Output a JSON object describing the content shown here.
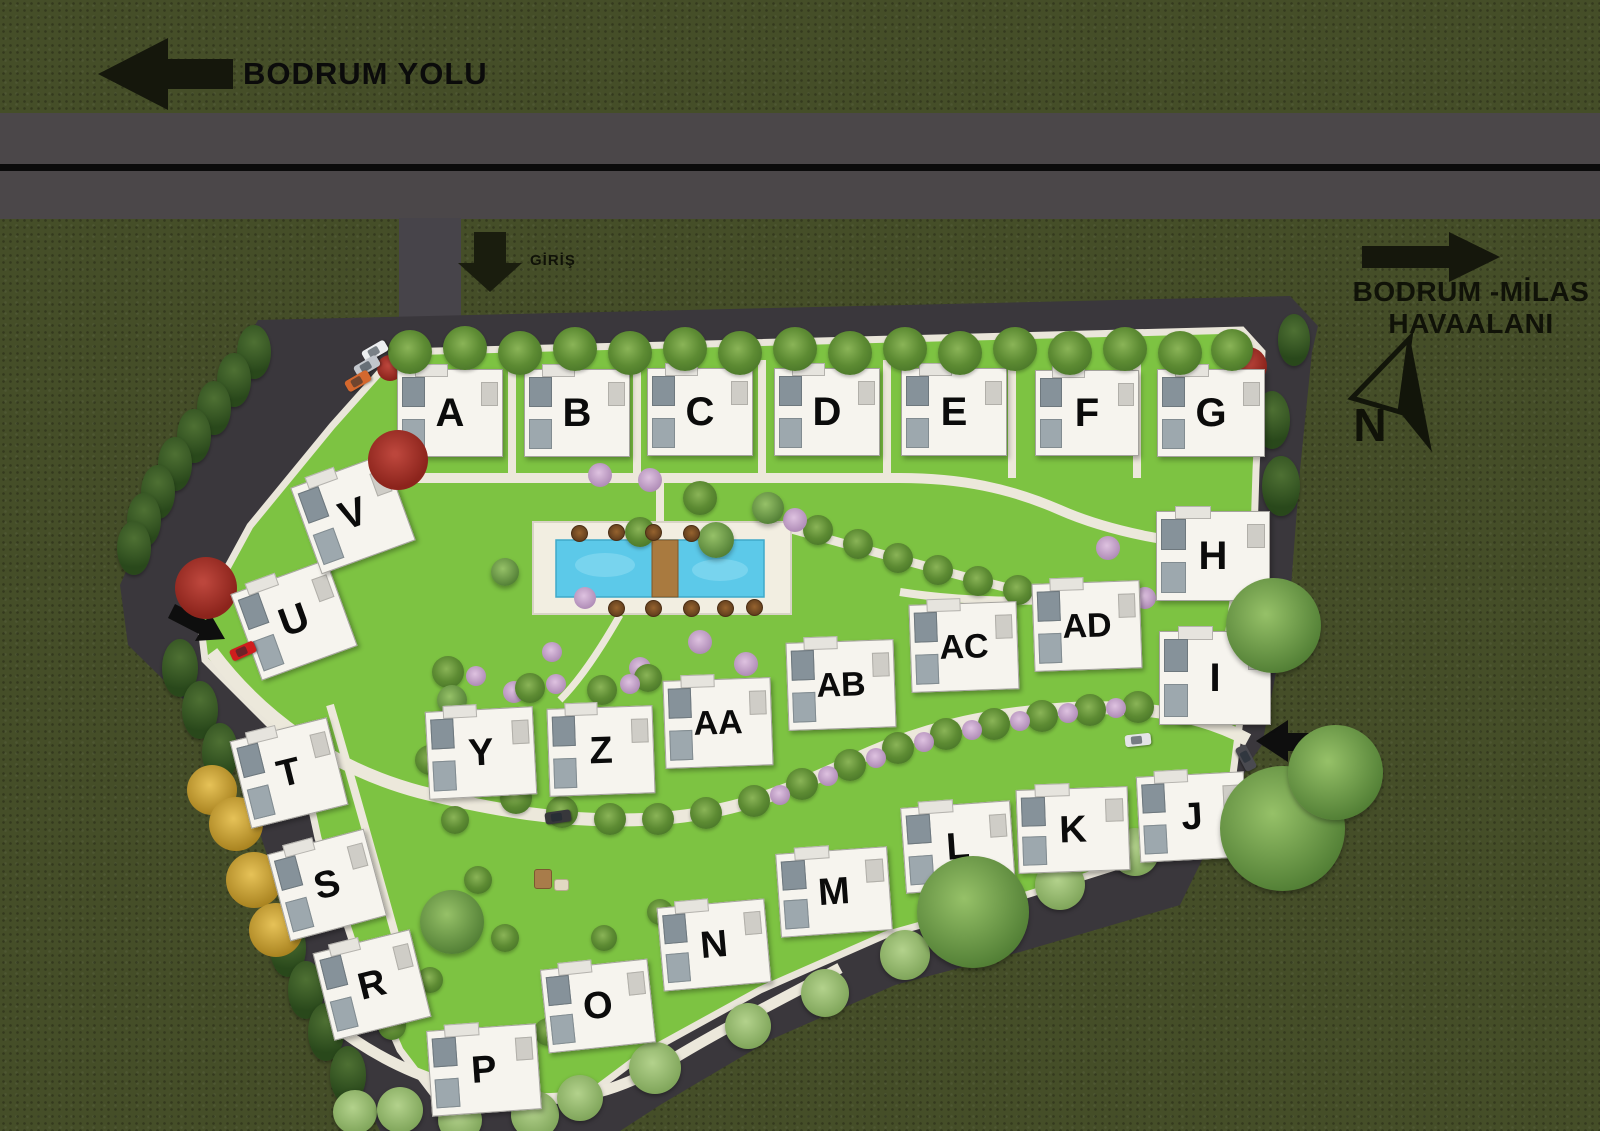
{
  "canvas": {
    "width": 1600,
    "height": 1131
  },
  "palette": {
    "outer_grass": "#454e28",
    "road": "#4b4749",
    "road_line": "#0b0b0b",
    "site_asphalt": "#3a373c",
    "lawn": "#7dc342",
    "path": "#ece8db",
    "pool_water": "#5cc9e9",
    "pool_deck": "#f2eee1",
    "building": "#f6f4ee",
    "sign_dark": "#15170c"
  },
  "signs": {
    "road_sign": {
      "label": "BODRUM YOLU",
      "direction": "left"
    },
    "entrance_sign": {
      "label": "GİRİŞ",
      "direction": "down"
    },
    "airport_sign": {
      "line1": "BODRUM -MİLAS",
      "line2": "HAVAALANI",
      "direction": "right"
    },
    "compass": {
      "label": "N"
    }
  },
  "buildings": [
    {
      "id": "A",
      "x": 449,
      "y": 412,
      "w": 104,
      "h": 86,
      "rot": 0,
      "fs": 40
    },
    {
      "id": "B",
      "x": 576,
      "y": 412,
      "w": 104,
      "h": 86,
      "rot": 0,
      "fs": 40
    },
    {
      "id": "C",
      "x": 699,
      "y": 411,
      "w": 104,
      "h": 86,
      "rot": 0,
      "fs": 40
    },
    {
      "id": "D",
      "x": 826,
      "y": 411,
      "w": 104,
      "h": 86,
      "rot": 0,
      "fs": 40
    },
    {
      "id": "E",
      "x": 953,
      "y": 411,
      "w": 104,
      "h": 86,
      "rot": 0,
      "fs": 40
    },
    {
      "id": "F",
      "x": 1086,
      "y": 412,
      "w": 102,
      "h": 84,
      "rot": 0,
      "fs": 40
    },
    {
      "id": "G",
      "x": 1210,
      "y": 412,
      "w": 106,
      "h": 86,
      "rot": 0,
      "fs": 40
    },
    {
      "id": "H",
      "x": 1212,
      "y": 555,
      "w": 112,
      "h": 88,
      "rot": 0,
      "fs": 40
    },
    {
      "id": "I",
      "x": 1214,
      "y": 677,
      "w": 110,
      "h": 92,
      "rot": 0,
      "fs": 40
    },
    {
      "id": "J",
      "x": 1191,
      "y": 816,
      "w": 106,
      "h": 84,
      "rot": -3,
      "fs": 38
    },
    {
      "id": "K",
      "x": 1072,
      "y": 829,
      "w": 110,
      "h": 82,
      "rot": -2,
      "fs": 38
    },
    {
      "id": "L",
      "x": 957,
      "y": 846,
      "w": 108,
      "h": 84,
      "rot": -4,
      "fs": 38
    },
    {
      "id": "M",
      "x": 833,
      "y": 891,
      "w": 110,
      "h": 82,
      "rot": -4,
      "fs": 38
    },
    {
      "id": "N",
      "x": 713,
      "y": 944,
      "w": 106,
      "h": 82,
      "rot": -5,
      "fs": 38
    },
    {
      "id": "O",
      "x": 597,
      "y": 1005,
      "w": 106,
      "h": 82,
      "rot": -6,
      "fs": 38
    },
    {
      "id": "P",
      "x": 483,
      "y": 1069,
      "w": 108,
      "h": 84,
      "rot": -4,
      "fs": 38
    },
    {
      "id": "R",
      "x": 371,
      "y": 984,
      "w": 98,
      "h": 88,
      "rot": -14,
      "fs": 38
    },
    {
      "id": "S",
      "x": 326,
      "y": 884,
      "w": 98,
      "h": 88,
      "rot": -15,
      "fs": 38
    },
    {
      "id": "T",
      "x": 288,
      "y": 772,
      "w": 98,
      "h": 88,
      "rot": -14,
      "fs": 38
    },
    {
      "id": "U",
      "x": 293,
      "y": 619,
      "w": 100,
      "h": 90,
      "rot": -20,
      "fs": 40
    },
    {
      "id": "V",
      "x": 352,
      "y": 513,
      "w": 98,
      "h": 90,
      "rot": -20,
      "fs": 40
    },
    {
      "id": "Y",
      "x": 480,
      "y": 752,
      "w": 106,
      "h": 86,
      "rot": -3,
      "fs": 38
    },
    {
      "id": "Z",
      "x": 600,
      "y": 750,
      "w": 104,
      "h": 86,
      "rot": -2,
      "fs": 38
    },
    {
      "id": "AA",
      "x": 717,
      "y": 722,
      "w": 106,
      "h": 86,
      "rot": -2,
      "fs": 34
    },
    {
      "id": "AB",
      "x": 840,
      "y": 684,
      "w": 106,
      "h": 86,
      "rot": -2,
      "fs": 34
    },
    {
      "id": "AC",
      "x": 963,
      "y": 646,
      "w": 106,
      "h": 86,
      "rot": -2,
      "fs": 34
    },
    {
      "id": "AD",
      "x": 1086,
      "y": 625,
      "w": 106,
      "h": 86,
      "rot": -2,
      "fs": 34
    }
  ],
  "pool": {
    "deck": {
      "x": 533,
      "y": 522,
      "w": 258,
      "h": 92
    },
    "water": {
      "x": 556,
      "y": 540,
      "w": 208,
      "h": 57
    },
    "bridge": {
      "x": 652,
      "y": 540,
      "w": 26,
      "h": 57
    }
  },
  "cars": [
    {
      "x": 375,
      "y": 351,
      "rot": -30,
      "color": "#eceef0"
    },
    {
      "x": 367,
      "y": 366,
      "rot": -30,
      "color": "#c2c6cc"
    },
    {
      "x": 358,
      "y": 381,
      "rot": -30,
      "color": "#d4682e"
    },
    {
      "x": 243,
      "y": 651,
      "rot": -24,
      "color": "#cf1d1d"
    },
    {
      "x": 558,
      "y": 817,
      "rot": -8,
      "color": "#37373b"
    },
    {
      "x": 1138,
      "y": 740,
      "rot": -6,
      "color": "#e4e4e6"
    },
    {
      "x": 1246,
      "y": 758,
      "rot": 62,
      "color": "#4a4a50"
    }
  ],
  "trees": [
    {
      "t": "palm",
      "x": 410,
      "y": 352,
      "s": 44,
      "top": true
    },
    {
      "t": "palm",
      "x": 465,
      "y": 348,
      "s": 44,
      "top": true
    },
    {
      "t": "palm",
      "x": 520,
      "y": 353,
      "s": 44,
      "top": true
    },
    {
      "t": "palm",
      "x": 575,
      "y": 349,
      "s": 44,
      "top": true
    },
    {
      "t": "palm",
      "x": 630,
      "y": 353,
      "s": 44,
      "top": true
    },
    {
      "t": "palm",
      "x": 685,
      "y": 349,
      "s": 44,
      "top": true
    },
    {
      "t": "palm",
      "x": 740,
      "y": 353,
      "s": 44,
      "top": true
    },
    {
      "t": "palm",
      "x": 795,
      "y": 349,
      "s": 44,
      "top": true
    },
    {
      "t": "palm",
      "x": 850,
      "y": 353,
      "s": 44,
      "top": true
    },
    {
      "t": "palm",
      "x": 905,
      "y": 349,
      "s": 44,
      "top": true
    },
    {
      "t": "palm",
      "x": 960,
      "y": 353,
      "s": 44,
      "top": true
    },
    {
      "t": "palm",
      "x": 1015,
      "y": 349,
      "s": 44,
      "top": true
    },
    {
      "t": "palm",
      "x": 1070,
      "y": 353,
      "s": 44,
      "top": true
    },
    {
      "t": "palm",
      "x": 1125,
      "y": 349,
      "s": 44,
      "top": true
    },
    {
      "t": "palm",
      "x": 1180,
      "y": 353,
      "s": 44,
      "top": true
    },
    {
      "t": "palm",
      "x": 1232,
      "y": 350,
      "s": 42,
      "top": true
    },
    {
      "t": "conifer",
      "x": 254,
      "y": 352,
      "s": 34
    },
    {
      "t": "conifer",
      "x": 234,
      "y": 380,
      "s": 34
    },
    {
      "t": "conifer",
      "x": 214,
      "y": 408,
      "s": 34
    },
    {
      "t": "conifer",
      "x": 194,
      "y": 436,
      "s": 34
    },
    {
      "t": "conifer",
      "x": 175,
      "y": 464,
      "s": 34
    },
    {
      "t": "conifer",
      "x": 158,
      "y": 492,
      "s": 34
    },
    {
      "t": "conifer",
      "x": 144,
      "y": 520,
      "s": 34
    },
    {
      "t": "conifer",
      "x": 134,
      "y": 548,
      "s": 34
    },
    {
      "t": "conifer",
      "x": 180,
      "y": 668,
      "s": 36
    },
    {
      "t": "conifer",
      "x": 200,
      "y": 710,
      "s": 36
    },
    {
      "t": "conifer",
      "x": 220,
      "y": 752,
      "s": 36
    },
    {
      "t": "conifer",
      "x": 288,
      "y": 948,
      "s": 36
    },
    {
      "t": "conifer",
      "x": 306,
      "y": 990,
      "s": 36
    },
    {
      "t": "conifer",
      "x": 326,
      "y": 1032,
      "s": 36
    },
    {
      "t": "conifer",
      "x": 348,
      "y": 1075,
      "s": 36
    },
    {
      "t": "yellow",
      "x": 212,
      "y": 790,
      "s": 50
    },
    {
      "t": "yellow",
      "x": 236,
      "y": 824,
      "s": 54
    },
    {
      "t": "yellow",
      "x": 254,
      "y": 880,
      "s": 56
    },
    {
      "t": "yellow",
      "x": 276,
      "y": 930,
      "s": 54
    },
    {
      "t": "red",
      "x": 398,
      "y": 460,
      "s": 60,
      "top": true
    },
    {
      "t": "red",
      "x": 206,
      "y": 588,
      "s": 62
    },
    {
      "t": "red",
      "x": 1248,
      "y": 366,
      "s": 38
    },
    {
      "t": "red",
      "x": 390,
      "y": 368,
      "s": 26
    },
    {
      "t": "palm",
      "x": 516,
      "y": 798,
      "s": 32
    },
    {
      "t": "palm",
      "x": 562,
      "y": 812,
      "s": 32
    },
    {
      "t": "palm",
      "x": 610,
      "y": 819,
      "s": 32
    },
    {
      "t": "palm",
      "x": 658,
      "y": 819,
      "s": 32
    },
    {
      "t": "palm",
      "x": 706,
      "y": 813,
      "s": 32
    },
    {
      "t": "palm",
      "x": 754,
      "y": 801,
      "s": 32
    },
    {
      "t": "palm",
      "x": 802,
      "y": 784,
      "s": 32
    },
    {
      "t": "palm",
      "x": 850,
      "y": 765,
      "s": 32
    },
    {
      "t": "palm",
      "x": 898,
      "y": 748,
      "s": 32
    },
    {
      "t": "palm",
      "x": 946,
      "y": 734,
      "s": 32
    },
    {
      "t": "palm",
      "x": 994,
      "y": 724,
      "s": 32
    },
    {
      "t": "palm",
      "x": 1042,
      "y": 716,
      "s": 32
    },
    {
      "t": "palm",
      "x": 1090,
      "y": 710,
      "s": 32
    },
    {
      "t": "palm",
      "x": 1138,
      "y": 707,
      "s": 32
    },
    {
      "t": "palm",
      "x": 1186,
      "y": 709,
      "s": 32
    },
    {
      "t": "pink",
      "x": 780,
      "y": 795,
      "s": 20
    },
    {
      "t": "pink",
      "x": 828,
      "y": 776,
      "s": 20
    },
    {
      "t": "pink",
      "x": 876,
      "y": 758,
      "s": 20
    },
    {
      "t": "pink",
      "x": 924,
      "y": 742,
      "s": 20
    },
    {
      "t": "pink",
      "x": 972,
      "y": 730,
      "s": 20
    },
    {
      "t": "pink",
      "x": 1020,
      "y": 721,
      "s": 20
    },
    {
      "t": "pink",
      "x": 1068,
      "y": 713,
      "s": 20
    },
    {
      "t": "pink",
      "x": 1116,
      "y": 708,
      "s": 20
    },
    {
      "t": "palm",
      "x": 818,
      "y": 530,
      "s": 30
    },
    {
      "t": "palm",
      "x": 858,
      "y": 544,
      "s": 30
    },
    {
      "t": "palm",
      "x": 898,
      "y": 558,
      "s": 30
    },
    {
      "t": "palm",
      "x": 938,
      "y": 570,
      "s": 30
    },
    {
      "t": "palm",
      "x": 978,
      "y": 581,
      "s": 30
    },
    {
      "t": "palm",
      "x": 1018,
      "y": 590,
      "s": 30
    },
    {
      "t": "pink",
      "x": 650,
      "y": 480,
      "s": 24
    },
    {
      "t": "pink",
      "x": 600,
      "y": 475,
      "s": 24
    },
    {
      "t": "pink",
      "x": 700,
      "y": 642,
      "s": 24
    },
    {
      "t": "pink",
      "x": 746,
      "y": 664,
      "s": 24
    },
    {
      "t": "pink",
      "x": 640,
      "y": 668,
      "s": 22
    },
    {
      "t": "pink",
      "x": 552,
      "y": 652,
      "s": 20
    },
    {
      "t": "pink",
      "x": 514,
      "y": 692,
      "s": 22
    },
    {
      "t": "pink",
      "x": 795,
      "y": 520,
      "s": 24
    },
    {
      "t": "pink",
      "x": 585,
      "y": 598,
      "s": 22
    },
    {
      "t": "green",
      "x": 768,
      "y": 508,
      "s": 32
    },
    {
      "t": "green",
      "x": 716,
      "y": 540,
      "s": 36
    },
    {
      "t": "palm",
      "x": 700,
      "y": 498,
      "s": 34
    },
    {
      "t": "palm",
      "x": 640,
      "y": 532,
      "s": 30
    },
    {
      "t": "green",
      "x": 505,
      "y": 572,
      "s": 28
    },
    {
      "t": "palm",
      "x": 448,
      "y": 672,
      "s": 32
    },
    {
      "t": "palm",
      "x": 530,
      "y": 688,
      "s": 30
    },
    {
      "t": "palm",
      "x": 602,
      "y": 690,
      "s": 30
    },
    {
      "t": "palm",
      "x": 648,
      "y": 678,
      "s": 28
    },
    {
      "t": "pink",
      "x": 476,
      "y": 676,
      "s": 20
    },
    {
      "t": "pink",
      "x": 556,
      "y": 684,
      "s": 20
    },
    {
      "t": "pink",
      "x": 630,
      "y": 684,
      "s": 20
    },
    {
      "t": "palm",
      "x": 430,
      "y": 760,
      "s": 30
    },
    {
      "t": "palm",
      "x": 455,
      "y": 820,
      "s": 28
    },
    {
      "t": "palm",
      "x": 478,
      "y": 880,
      "s": 28
    },
    {
      "t": "palm",
      "x": 505,
      "y": 938,
      "s": 28
    },
    {
      "t": "green",
      "x": 452,
      "y": 700,
      "s": 30
    },
    {
      "t": "green",
      "x": 452,
      "y": 922,
      "s": 64
    },
    {
      "t": "palm",
      "x": 392,
      "y": 1026,
      "s": 28
    },
    {
      "t": "palm",
      "x": 548,
      "y": 1032,
      "s": 28
    },
    {
      "t": "palm",
      "x": 604,
      "y": 938,
      "s": 26
    },
    {
      "t": "palm",
      "x": 660,
      "y": 912,
      "s": 26
    },
    {
      "t": "palm",
      "x": 430,
      "y": 980,
      "s": 26
    },
    {
      "t": "light",
      "x": 355,
      "y": 1112,
      "s": 44
    },
    {
      "t": "light",
      "x": 400,
      "y": 1110,
      "s": 46
    },
    {
      "t": "light",
      "x": 460,
      "y": 1120,
      "s": 44
    },
    {
      "t": "light",
      "x": 535,
      "y": 1115,
      "s": 48
    },
    {
      "t": "light",
      "x": 580,
      "y": 1098,
      "s": 46
    },
    {
      "t": "light",
      "x": 655,
      "y": 1068,
      "s": 52
    },
    {
      "t": "light",
      "x": 748,
      "y": 1026,
      "s": 46
    },
    {
      "t": "light",
      "x": 825,
      "y": 993,
      "s": 48
    },
    {
      "t": "light",
      "x": 905,
      "y": 955,
      "s": 50
    },
    {
      "t": "light",
      "x": 1060,
      "y": 885,
      "s": 50
    },
    {
      "t": "light",
      "x": 1135,
      "y": 852,
      "s": 48
    },
    {
      "t": "light",
      "x": 1205,
      "y": 820,
      "s": 46
    },
    {
      "t": "green",
      "x": 973,
      "y": 912,
      "s": 112,
      "top": true
    },
    {
      "t": "green",
      "x": 1282,
      "y": 828,
      "s": 125,
      "top": true
    },
    {
      "t": "green",
      "x": 1335,
      "y": 772,
      "s": 95,
      "top": true
    },
    {
      "t": "green",
      "x": 1273,
      "y": 625,
      "s": 95,
      "top": true
    },
    {
      "t": "conifer",
      "x": 1272,
      "y": 420,
      "s": 36
    },
    {
      "t": "conifer",
      "x": 1281,
      "y": 486,
      "s": 38
    },
    {
      "t": "conifer",
      "x": 1294,
      "y": 340,
      "s": 32
    },
    {
      "t": "pink",
      "x": 1108,
      "y": 548,
      "s": 24
    },
    {
      "t": "pink",
      "x": 1145,
      "y": 598,
      "s": 22
    },
    {
      "t": "umbrella",
      "x": 578,
      "y": 532,
      "s": 15
    },
    {
      "t": "umbrella",
      "x": 615,
      "y": 531,
      "s": 15
    },
    {
      "t": "umbrella",
      "x": 652,
      "y": 531,
      "s": 15
    },
    {
      "t": "umbrella",
      "x": 690,
      "y": 532,
      "s": 15
    },
    {
      "t": "umbrella",
      "x": 615,
      "y": 607,
      "s": 15
    },
    {
      "t": "umbrella",
      "x": 652,
      "y": 607,
      "s": 15
    },
    {
      "t": "umbrella",
      "x": 690,
      "y": 607,
      "s": 15
    },
    {
      "t": "umbrella",
      "x": 724,
      "y": 607,
      "s": 15
    },
    {
      "t": "umbrella",
      "x": 753,
      "y": 606,
      "s": 15
    },
    {
      "t": "play1",
      "x": 542,
      "y": 878,
      "s": 16
    },
    {
      "t": "play2",
      "x": 560,
      "y": 884,
      "s": 13
    }
  ]
}
